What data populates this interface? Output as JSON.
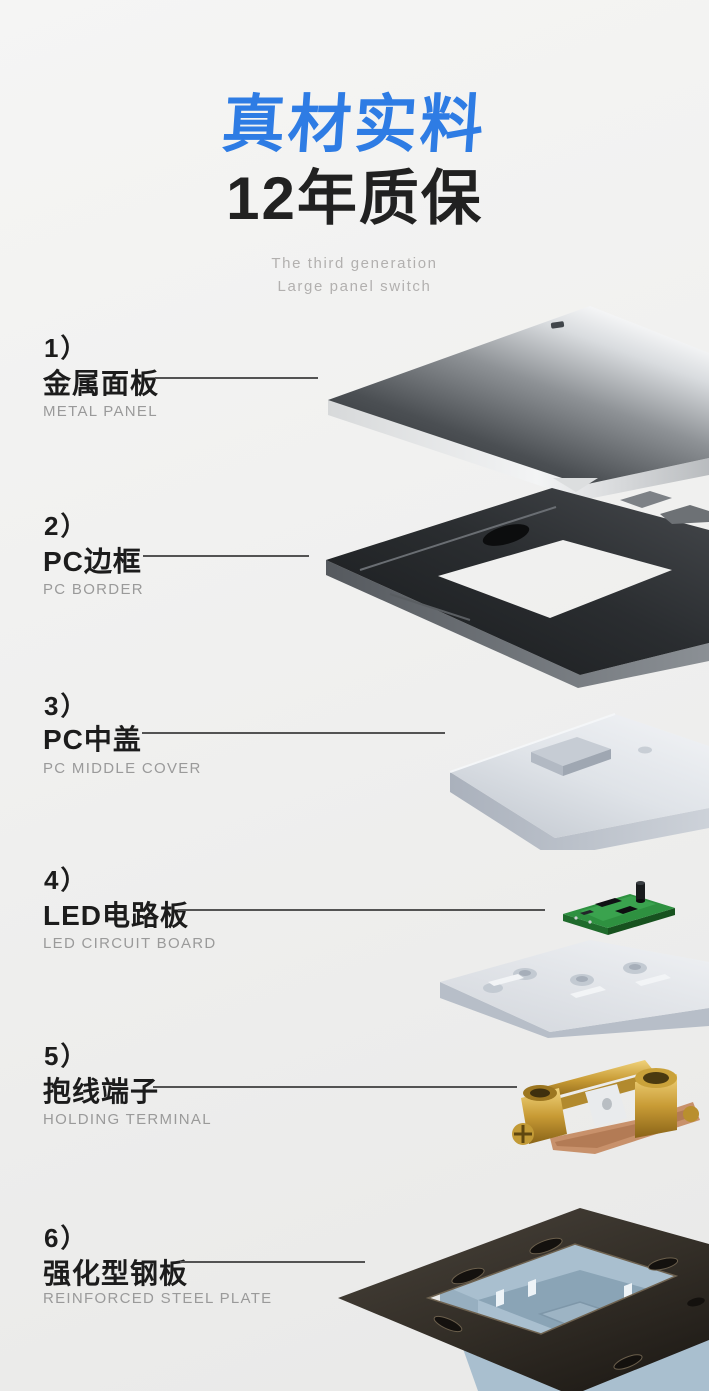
{
  "header": {
    "title": "真材实料",
    "subtitle": "12年质保",
    "tagline": [
      "The third generation",
      "Large panel switch"
    ]
  },
  "parts": [
    {
      "index": "1）",
      "name": "金属面板",
      "caption": "METAL PANEL",
      "illustration": "metal-panel-3d"
    },
    {
      "index": "2）",
      "name": "PC边框",
      "caption": "PC BORDER",
      "illustration": "pc-border-frame-3d"
    },
    {
      "index": "3）",
      "name": "PC中盖",
      "caption": "PC MIDDLE COVER",
      "illustration": "pc-middle-cover-3d"
    },
    {
      "index": "4）",
      "name": "LED电路板",
      "caption": "LED CIRCUIT BOARD",
      "illustration": "led-circuit-board-3d"
    },
    {
      "index": "5）",
      "name": "抱线端子",
      "caption": "HOLDING TERMINAL",
      "illustration": "holding-terminal-3d"
    },
    {
      "index": "6）",
      "name": "强化型钢板",
      "caption": "REINFORCED STEEL PLATE",
      "illustration": "reinforced-steel-plate-3d"
    }
  ],
  "colors": {
    "accent_blue": "#2e7ce4",
    "heading_dark": "#1d1d1d",
    "caption_gray": "#9a9a9a",
    "tagline_gray": "#b2b0af",
    "connector_line": "#535353",
    "background": "#f0f0ef",
    "pcb_green": "#2e9140",
    "brass_gold": "#c89b35",
    "housing_blue": "#a9bfcf"
  }
}
